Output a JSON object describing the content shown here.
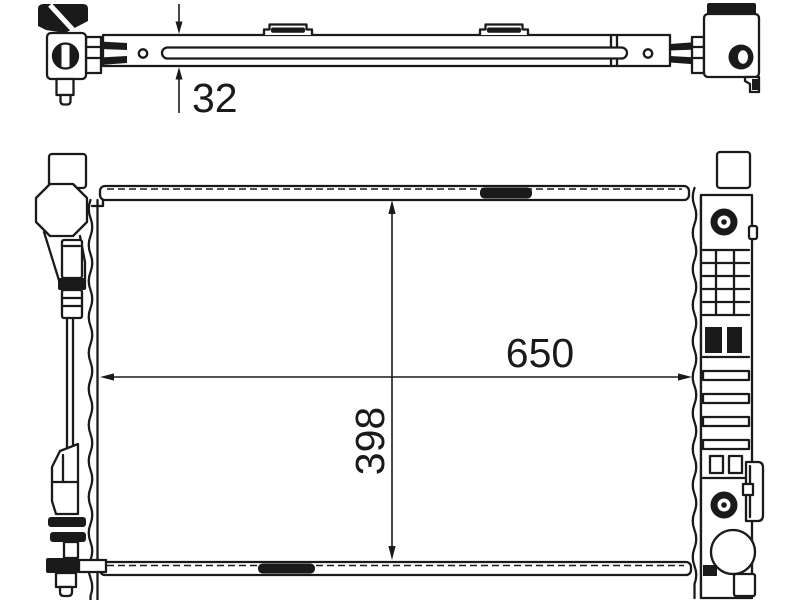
{
  "page": {
    "background_color": "#ffffff"
  },
  "drawing": {
    "stroke_color": "#1a1a1a",
    "dimension_labels": {
      "depth": "32",
      "width": "650",
      "height": "398"
    }
  }
}
